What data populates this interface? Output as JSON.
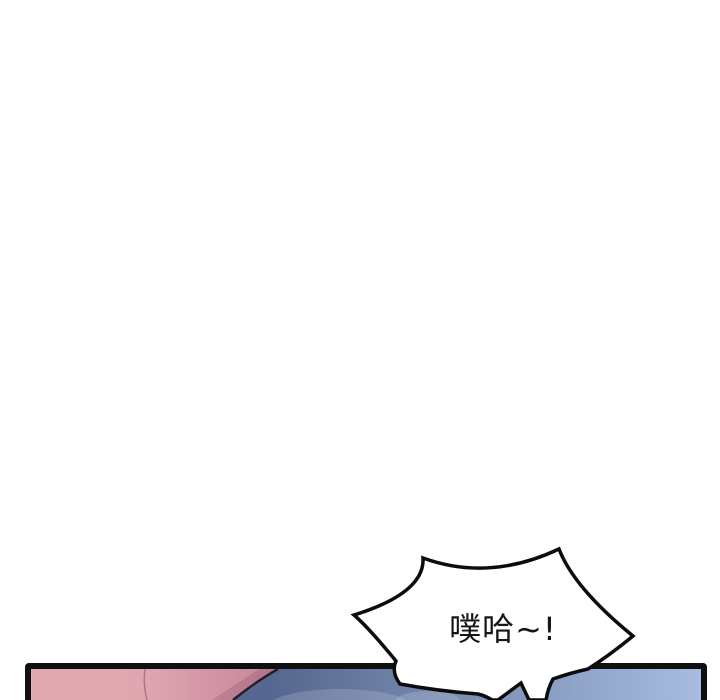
{
  "page": {
    "background": "#ffffff"
  },
  "bubble": {
    "text": "噗哈~!",
    "text_color": "#161616",
    "fill": "#ffffff",
    "outline_color": "#0c0c0c"
  },
  "panel": {
    "border_color": "#101010",
    "pink_left": "#e2a9b2",
    "pink_mid": "#e0a7b1",
    "pink_right": "#c5849a",
    "pink_seam_color": "#a96c80",
    "pink_shadow": "rgba(120,60,80,0.22)",
    "hair_edge_color": "#231d28",
    "blue_left": "#55678e",
    "blue_right": "#aabee2",
    "highlight": "rgba(255,255,255,0.16)"
  }
}
